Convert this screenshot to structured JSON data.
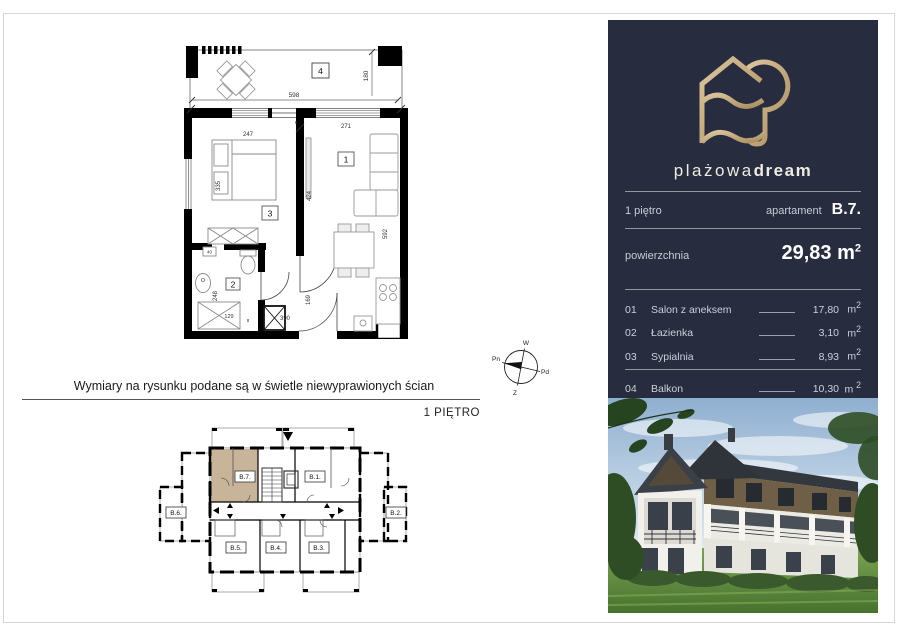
{
  "note": "Wymiary na rysunku podane są w świetle niewyprawionych ścian",
  "floor_plan_label": "1 PIĘTRO",
  "compass": {
    "top": "W",
    "right": "Pd",
    "bottom": "Z",
    "left": "Pn"
  },
  "plan": {
    "rooms": {
      "living": "1",
      "bath": "2",
      "bedroom": "3",
      "balcony": "4"
    },
    "dims": {
      "balcony_w": "598",
      "balcony_h": "180",
      "bedroom_w": "247",
      "living_w": "271",
      "bedroom_h": "335",
      "divider_h": "424",
      "living_h": "592",
      "hall_h": "169",
      "bottom_w": "390",
      "shower_w": "129",
      "bath_h": "248",
      "shelf_w": "40",
      "wall_a": "8",
      "wall_b": "8"
    }
  },
  "building": {
    "b1": "B.1.",
    "b2": "B.2.",
    "b3": "B.3.",
    "b4": "B.4.",
    "b5": "B.5.",
    "b6": "B.6.",
    "b7": "B.7."
  },
  "panel": {
    "brand": {
      "light": "plażowa",
      "bold": "dream"
    },
    "floor_label": "1 piętro",
    "apartment_label": "apartament",
    "apartment_value": "B.7.",
    "area_label": "powierzchnia",
    "area_value": "29,83",
    "unit_base": "m",
    "unit_sup": "2",
    "rooms": [
      {
        "no": "01",
        "name": "Salon z aneksem",
        "area": "17,80"
      },
      {
        "no": "02",
        "name": "Łazienka",
        "area": "3,10"
      },
      {
        "no": "03",
        "name": "Sypialnia",
        "area": "8,93"
      },
      {
        "no": "04",
        "name": "Balkon",
        "area": "10,30"
      }
    ]
  },
  "colors": {
    "panel_bg": "#272c3e",
    "gold": "#c2a371",
    "unit_highlight": "#c8b599"
  }
}
